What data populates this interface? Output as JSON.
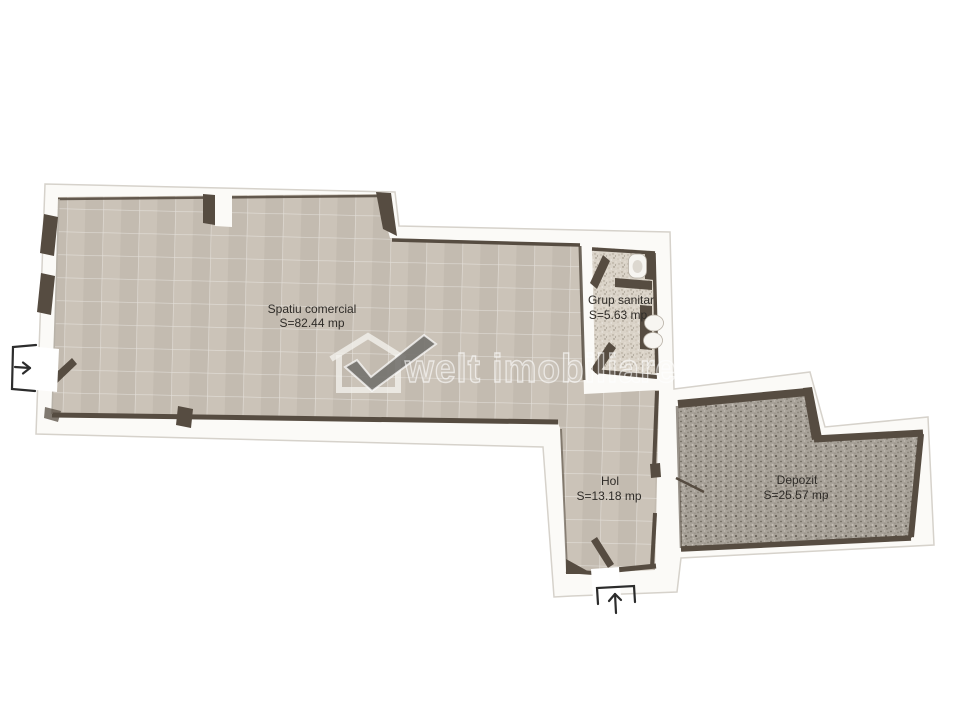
{
  "page": {
    "background": "#ffffff",
    "type": "real-estate floor plan"
  },
  "watermark": {
    "brand": "welt imobiliare"
  },
  "plan": {
    "rooms": [
      {
        "id": "spatiu-comercial",
        "name": "Spatiu comercial",
        "area": "S=82.44 mp"
      },
      {
        "id": "grup-sanitar",
        "name": "Grup sanitar",
        "area": "S=5.63 mp"
      },
      {
        "id": "hol",
        "name": "Hol",
        "area": "S=13.18 mp"
      },
      {
        "id": "depozit",
        "name": "Depozit",
        "area": "S=25.57 mp"
      }
    ],
    "colors": {
      "wall_fill": "#fbfaf7",
      "wall_outline": "#d6d2cb",
      "wall_dark": "#564c41",
      "tile_floor": "#c8c0b4",
      "bathroom_floor": "#dad3c8",
      "storage_floor": "#a8a299",
      "fixture_fill": "#f7f5f1",
      "label_color": "#2f2c28",
      "icon_color": "#2c2c2c"
    },
    "entrances": [
      {
        "position": "left",
        "icon": "arrow-right-into-plan"
      },
      {
        "position": "bottom",
        "icon": "arrow-up-into-plan"
      }
    ],
    "fixtures": [
      "toilet",
      "sink",
      "doors",
      "windows"
    ]
  }
}
